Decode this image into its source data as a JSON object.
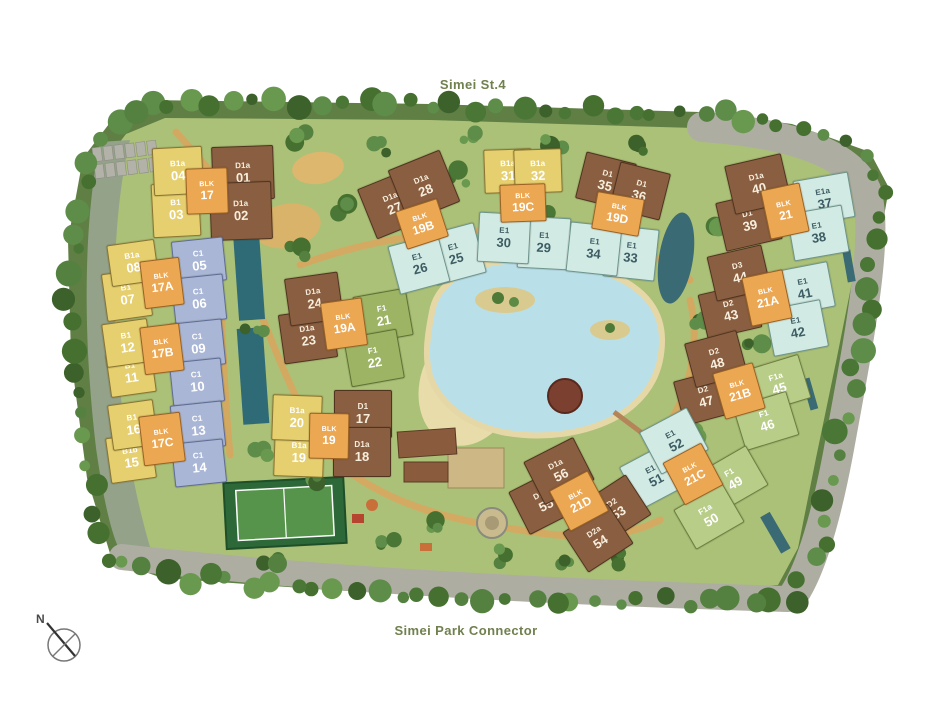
{
  "titles": {
    "top_road": "Simei St.4",
    "bottom_road": "Simei Park Connector"
  },
  "compass": {
    "label": "N"
  },
  "colors": {
    "B": {
      "bg": "#e5cf6f",
      "border": "#8a7430",
      "text": "#ffffff"
    },
    "C": {
      "bg": "#a9b6d5",
      "border": "#5f6d96",
      "text": "#ffffff"
    },
    "D": {
      "bg": "#8a5e40",
      "border": "#503420",
      "text": "#f7eedd"
    },
    "E": {
      "bg": "#d2eae4",
      "border": "#6d958c",
      "text": "#3d5c63"
    },
    "F": {
      "bg": "#9cb464",
      "border": "#5f7234",
      "text": "#ffffff"
    },
    "Fa": {
      "bg": "#b8cd88",
      "border": "#6d7f40",
      "text": "#ffffff"
    },
    "BLK": {
      "bg": "#eca752",
      "border": "#9a6224",
      "text": "#ffffff"
    },
    "road_label_text": "#70804e",
    "grass": "#abc178",
    "tree_ring": "#5f7f44",
    "road": "#adada2",
    "lagoon": "#b9dfe9",
    "sand": "#e8dcab",
    "footpath": "#d8a75f"
  },
  "site": {
    "stacks": [
      {
        "num": "01",
        "type": "D1a",
        "cat": "D",
        "cx": 242,
        "cy": 172,
        "w": 60,
        "h": 52,
        "r": -2
      },
      {
        "num": "02",
        "type": "D1a",
        "cat": "D",
        "cx": 240,
        "cy": 210,
        "w": 60,
        "h": 56,
        "r": -2
      },
      {
        "num": "03",
        "type": "B1",
        "cat": "B",
        "cx": 175,
        "cy": 209,
        "w": 46,
        "h": 52,
        "r": -3
      },
      {
        "num": "04",
        "type": "B1a",
        "cat": "B",
        "cx": 177,
        "cy": 170,
        "w": 48,
        "h": 46,
        "r": -3
      },
      {
        "num": "05",
        "type": "C1",
        "cat": "C",
        "cx": 198,
        "cy": 260,
        "w": 50,
        "h": 42,
        "r": -6
      },
      {
        "num": "06",
        "type": "C1",
        "cat": "C",
        "cx": 198,
        "cy": 298,
        "w": 50,
        "h": 44,
        "r": -6
      },
      {
        "num": "07",
        "type": "B1",
        "cat": "B",
        "cx": 126,
        "cy": 294,
        "w": 44,
        "h": 46,
        "r": -8
      },
      {
        "num": "08",
        "type": "B1a",
        "cat": "B",
        "cx": 132,
        "cy": 262,
        "w": 46,
        "h": 40,
        "r": -8
      },
      {
        "num": "09",
        "type": "C1",
        "cat": "C",
        "cx": 197,
        "cy": 343,
        "w": 50,
        "h": 44,
        "r": -6
      },
      {
        "num": "10",
        "type": "C1",
        "cat": "C",
        "cx": 196,
        "cy": 381,
        "w": 50,
        "h": 42,
        "r": -6
      },
      {
        "num": "11",
        "type": "B1",
        "cat": "B",
        "cx": 130,
        "cy": 372,
        "w": 44,
        "h": 42,
        "r": -8
      },
      {
        "num": "12",
        "type": "B1",
        "cat": "B",
        "cx": 126,
        "cy": 342,
        "w": 44,
        "h": 42,
        "r": -8
      },
      {
        "num": "13",
        "type": "C1",
        "cat": "C",
        "cx": 197,
        "cy": 425,
        "w": 50,
        "h": 44,
        "r": -6
      },
      {
        "num": "14",
        "type": "C1",
        "cat": "C",
        "cx": 198,
        "cy": 462,
        "w": 50,
        "h": 42,
        "r": -6
      },
      {
        "num": "15",
        "type": "B1b",
        "cat": "B",
        "cx": 130,
        "cy": 457,
        "w": 44,
        "h": 44,
        "r": -8
      },
      {
        "num": "16",
        "type": "B1",
        "cat": "B",
        "cx": 132,
        "cy": 424,
        "w": 44,
        "h": 44,
        "r": -8
      },
      {
        "num": "17",
        "type": "D1",
        "cat": "D",
        "cx": 362,
        "cy": 413,
        "w": 56,
        "h": 46,
        "r": 0
      },
      {
        "num": "18",
        "type": "D1a",
        "cat": "D",
        "cx": 361,
        "cy": 451,
        "w": 56,
        "h": 48,
        "r": 0
      },
      {
        "num": "19",
        "type": "B1a",
        "cat": "B",
        "cx": 298,
        "cy": 452,
        "w": 48,
        "h": 46,
        "r": 2
      },
      {
        "num": "20",
        "type": "B1a",
        "cat": "B",
        "cx": 296,
        "cy": 417,
        "w": 48,
        "h": 44,
        "r": 2
      },
      {
        "num": "21",
        "type": "F1",
        "cat": "F",
        "cx": 382,
        "cy": 315,
        "w": 52,
        "h": 46,
        "r": -10
      },
      {
        "num": "22",
        "type": "F1",
        "cat": "F",
        "cx": 373,
        "cy": 357,
        "w": 52,
        "h": 48,
        "r": -10
      },
      {
        "num": "23",
        "type": "D1a",
        "cat": "D",
        "cx": 307,
        "cy": 335,
        "w": 52,
        "h": 48,
        "r": -8
      },
      {
        "num": "24",
        "type": "D1a",
        "cat": "D",
        "cx": 313,
        "cy": 298,
        "w": 52,
        "h": 46,
        "r": -8
      },
      {
        "num": "25",
        "type": "E1",
        "cat": "E",
        "cx": 454,
        "cy": 253,
        "w": 50,
        "h": 50,
        "r": -15
      },
      {
        "num": "26",
        "type": "E1",
        "cat": "E",
        "cx": 418,
        "cy": 263,
        "w": 50,
        "h": 48,
        "r": -15
      },
      {
        "num": "27",
        "type": "D1a",
        "cat": "D",
        "cx": 392,
        "cy": 203,
        "w": 54,
        "h": 52,
        "r": -22
      },
      {
        "num": "28",
        "type": "D1a",
        "cat": "D",
        "cx": 423,
        "cy": 185,
        "w": 54,
        "h": 54,
        "r": -22
      },
      {
        "num": "29",
        "type": "E1",
        "cat": "E",
        "cx": 543,
        "cy": 242,
        "w": 50,
        "h": 50,
        "r": 3
      },
      {
        "num": "30",
        "type": "E1",
        "cat": "E",
        "cx": 503,
        "cy": 237,
        "w": 50,
        "h": 48,
        "r": 3
      },
      {
        "num": "31",
        "type": "B1a",
        "cat": "B",
        "cx": 507,
        "cy": 170,
        "w": 46,
        "h": 42,
        "r": -2
      },
      {
        "num": "32",
        "type": "B1a",
        "cat": "B",
        "cx": 537,
        "cy": 170,
        "w": 46,
        "h": 42,
        "r": -2
      },
      {
        "num": "33",
        "type": "E1",
        "cat": "E",
        "cx": 630,
        "cy": 252,
        "w": 50,
        "h": 50,
        "r": 6
      },
      {
        "num": "34",
        "type": "E1",
        "cat": "E",
        "cx": 593,
        "cy": 248,
        "w": 50,
        "h": 48,
        "r": 6
      },
      {
        "num": "35",
        "type": "D1",
        "cat": "D",
        "cx": 605,
        "cy": 180,
        "w": 50,
        "h": 46,
        "r": 14
      },
      {
        "num": "36",
        "type": "D1",
        "cat": "D",
        "cx": 639,
        "cy": 190,
        "w": 50,
        "h": 46,
        "r": 14
      },
      {
        "num": "37",
        "type": "E1a",
        "cat": "E",
        "cx": 823,
        "cy": 198,
        "w": 54,
        "h": 44,
        "r": -10
      },
      {
        "num": "38",
        "type": "E1",
        "cat": "E",
        "cx": 817,
        "cy": 232,
        "w": 54,
        "h": 46,
        "r": -10
      },
      {
        "num": "39",
        "type": "D1",
        "cat": "D",
        "cx": 748,
        "cy": 220,
        "w": 56,
        "h": 48,
        "r": -13
      },
      {
        "num": "40",
        "type": "D1a",
        "cat": "D",
        "cx": 757,
        "cy": 183,
        "w": 56,
        "h": 48,
        "r": -13
      },
      {
        "num": "41",
        "type": "E1",
        "cat": "E",
        "cx": 803,
        "cy": 288,
        "w": 54,
        "h": 44,
        "r": -11
      },
      {
        "num": "42",
        "type": "E1",
        "cat": "E",
        "cx": 796,
        "cy": 327,
        "w": 54,
        "h": 46,
        "r": -11
      },
      {
        "num": "43",
        "type": "D2",
        "cat": "D",
        "cx": 729,
        "cy": 310,
        "w": 54,
        "h": 44,
        "r": -13
      },
      {
        "num": "44",
        "type": "D3",
        "cat": "D",
        "cx": 738,
        "cy": 272,
        "w": 54,
        "h": 44,
        "r": -13
      },
      {
        "num": "45",
        "type": "F1a",
        "cat": "Fa",
        "cx": 777,
        "cy": 383,
        "w": 54,
        "h": 44,
        "r": -17
      },
      {
        "num": "46",
        "type": "F1",
        "cat": "Fa",
        "cx": 765,
        "cy": 420,
        "w": 54,
        "h": 44,
        "r": -17
      },
      {
        "num": "47",
        "type": "D2",
        "cat": "D",
        "cx": 704,
        "cy": 396,
        "w": 52,
        "h": 44,
        "r": -15
      },
      {
        "num": "48",
        "type": "D2",
        "cat": "D",
        "cx": 715,
        "cy": 358,
        "w": 52,
        "h": 44,
        "r": -15
      },
      {
        "num": "49",
        "type": "F1",
        "cat": "Fa",
        "cx": 732,
        "cy": 478,
        "w": 54,
        "h": 44,
        "r": -30
      },
      {
        "num": "50",
        "type": "F1a",
        "cat": "Fa",
        "cx": 708,
        "cy": 515,
        "w": 54,
        "h": 44,
        "r": -30
      },
      {
        "num": "51",
        "type": "E1",
        "cat": "E",
        "cx": 653,
        "cy": 475,
        "w": 52,
        "h": 46,
        "r": -28
      },
      {
        "num": "52",
        "type": "E1",
        "cat": "E",
        "cx": 673,
        "cy": 440,
        "w": 52,
        "h": 46,
        "r": -28
      },
      {
        "num": "53",
        "type": "D2",
        "cat": "D",
        "cx": 615,
        "cy": 508,
        "w": 52,
        "h": 46,
        "r": -33
      },
      {
        "num": "54",
        "type": "D2a",
        "cat": "D",
        "cx": 597,
        "cy": 537,
        "w": 52,
        "h": 46,
        "r": -33
      },
      {
        "num": "55",
        "type": "D1a",
        "cat": "D",
        "cx": 543,
        "cy": 500,
        "w": 54,
        "h": 46,
        "r": -27
      },
      {
        "num": "56",
        "type": "D1a",
        "cat": "D",
        "cx": 558,
        "cy": 470,
        "w": 54,
        "h": 46,
        "r": -27
      }
    ],
    "blocks": [
      {
        "label": "BLK",
        "num": "17",
        "cx": 206,
        "cy": 190,
        "w": 40,
        "h": 44,
        "r": -2
      },
      {
        "label": "BLK",
        "num": "17A",
        "cx": 161,
        "cy": 282,
        "w": 38,
        "h": 46,
        "r": -7
      },
      {
        "label": "BLK",
        "num": "17B",
        "cx": 161,
        "cy": 348,
        "w": 38,
        "h": 46,
        "r": -7
      },
      {
        "label": "BLK",
        "num": "17C",
        "cx": 161,
        "cy": 438,
        "w": 40,
        "h": 48,
        "r": -7
      },
      {
        "label": "BLK",
        "num": "19",
        "cx": 328,
        "cy": 435,
        "w": 38,
        "h": 44,
        "r": 1
      },
      {
        "label": "BLK",
        "num": "19A",
        "cx": 343,
        "cy": 323,
        "w": 40,
        "h": 46,
        "r": -8
      },
      {
        "label": "BLK",
        "num": "19B",
        "cx": 421,
        "cy": 223,
        "w": 42,
        "h": 38,
        "r": -18
      },
      {
        "label": "BLK",
        "num": "19C",
        "cx": 522,
        "cy": 202,
        "w": 44,
        "h": 36,
        "r": -2
      },
      {
        "label": "BLK",
        "num": "19D",
        "cx": 617,
        "cy": 213,
        "w": 46,
        "h": 36,
        "r": 10
      },
      {
        "label": "BLK",
        "num": "21",
        "cx": 784,
        "cy": 210,
        "w": 38,
        "h": 48,
        "r": -12
      },
      {
        "label": "BLK",
        "num": "21A",
        "cx": 766,
        "cy": 297,
        "w": 40,
        "h": 48,
        "r": -12
      },
      {
        "label": "BLK",
        "num": "21B",
        "cx": 738,
        "cy": 390,
        "w": 40,
        "h": 46,
        "r": -16
      },
      {
        "label": "BLK",
        "num": "21C",
        "cx": 692,
        "cy": 473,
        "w": 42,
        "h": 46,
        "r": -28
      },
      {
        "label": "BLK",
        "num": "21D",
        "cx": 578,
        "cy": 500,
        "w": 42,
        "h": 44,
        "r": -28
      }
    ]
  }
}
